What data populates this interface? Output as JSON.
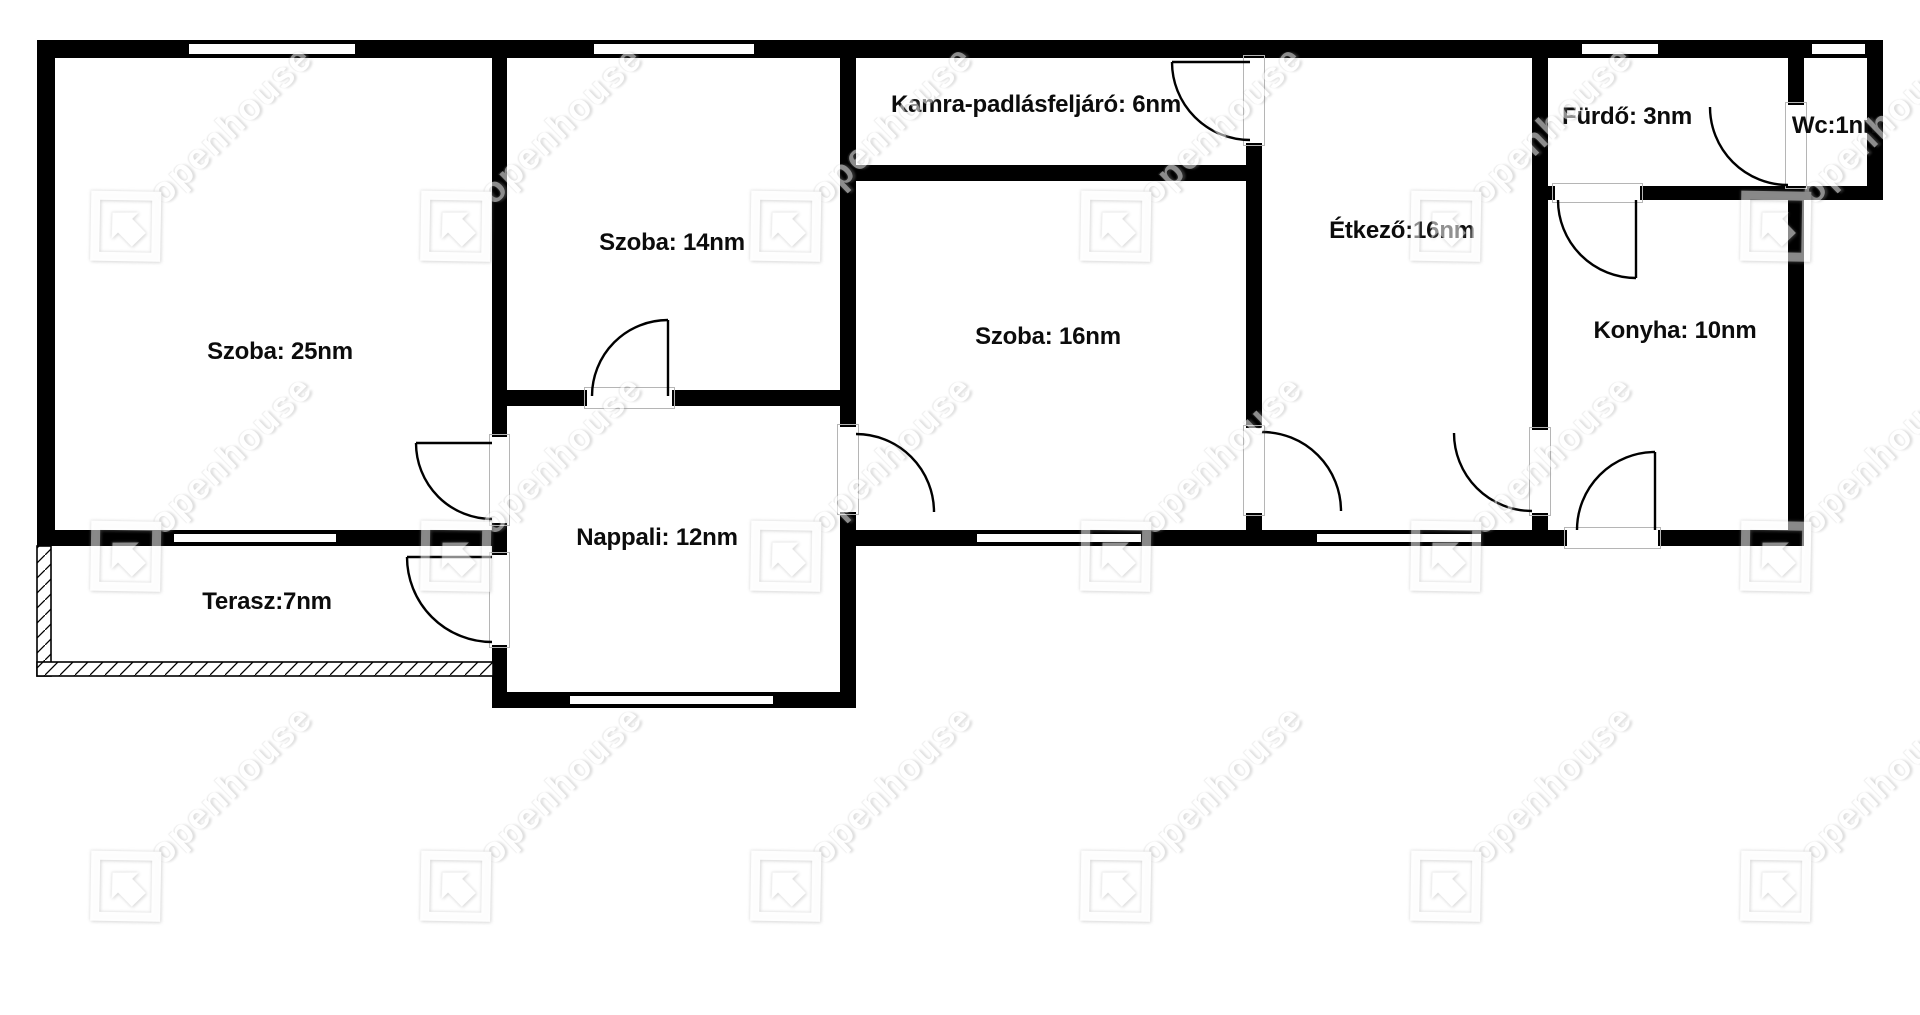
{
  "canvas": {
    "width": 1920,
    "height": 1015,
    "background": "#ffffff",
    "wall_color": "#000000"
  },
  "watermark": {
    "text": "openhouse",
    "angle_deg": -44,
    "grid": {
      "x0": 113,
      "y0": 226,
      "dx": 330,
      "dy": 330,
      "cols": 6,
      "rows": 3
    }
  },
  "rooms": [
    {
      "id": "szoba25",
      "label": "Szoba: 25nm",
      "cx": 280,
      "cy": 352
    },
    {
      "id": "szoba14",
      "label": "Szoba: 14nm",
      "cx": 672,
      "cy": 243
    },
    {
      "id": "kamra",
      "label": "Kamra-padlásfeljáró: 6nm",
      "cx": 1036,
      "cy": 105
    },
    {
      "id": "szoba16",
      "label": "Szoba: 16nm",
      "cx": 1048,
      "cy": 337
    },
    {
      "id": "etkezo",
      "label": "Étkező:16nm",
      "cx": 1402,
      "cy": 231
    },
    {
      "id": "furdo",
      "label": "Fürdő: 3nm",
      "cx": 1627,
      "cy": 117
    },
    {
      "id": "wc",
      "label": "Wc:1nm",
      "cx": 1838,
      "cy": 126
    },
    {
      "id": "konyha",
      "label": "Konyha: 10nm",
      "cx": 1675,
      "cy": 331
    },
    {
      "id": "nappali",
      "label": "Nappali: 12nm",
      "cx": 657,
      "cy": 538
    },
    {
      "id": "terasz",
      "label": "Terasz:7nm",
      "cx": 267,
      "cy": 602
    }
  ],
  "floorplan": {
    "walls": [
      [
        37,
        40,
        1846,
        18
      ],
      [
        37,
        40,
        18,
        506
      ],
      [
        37,
        530,
        470,
        16
      ],
      [
        840,
        530,
        964,
        16
      ],
      [
        492,
        58,
        15,
        650
      ],
      [
        840,
        58,
        16,
        650
      ],
      [
        492,
        692,
        364,
        16
      ],
      [
        507,
        390,
        333,
        16
      ],
      [
        856,
        165,
        390,
        16
      ],
      [
        1246,
        58,
        16,
        472
      ],
      [
        1532,
        58,
        16,
        472
      ],
      [
        1548,
        186,
        335,
        14
      ],
      [
        1788,
        58,
        16,
        488
      ],
      [
        1867,
        40,
        16,
        160
      ]
    ],
    "openings": [
      [
        492,
        437,
        15,
        86
      ],
      [
        492,
        555,
        15,
        90
      ],
      [
        587,
        390,
        85,
        16
      ],
      [
        840,
        427,
        16,
        85
      ],
      [
        1246,
        428,
        16,
        85
      ],
      [
        1246,
        58,
        16,
        85
      ],
      [
        1532,
        430,
        16,
        83
      ],
      [
        1555,
        186,
        85,
        14
      ],
      [
        1788,
        105,
        16,
        81
      ],
      [
        1567,
        530,
        91,
        16
      ]
    ],
    "windows": [
      [
        187,
        42,
        170,
        14
      ],
      [
        592,
        42,
        164,
        14
      ],
      [
        1580,
        42,
        80,
        14
      ],
      [
        1810,
        42,
        57,
        14
      ],
      [
        172,
        532,
        166,
        12
      ],
      [
        975,
        532,
        168,
        12
      ],
      [
        1315,
        532,
        168,
        12
      ],
      [
        568,
        694,
        207,
        12
      ]
    ],
    "hatched_walls": [
      [
        37,
        546,
        14,
        130
      ],
      [
        37,
        662,
        456,
        14
      ]
    ],
    "doors": [
      {
        "cx": 492,
        "cy": 443,
        "r": 76,
        "a1": 180,
        "a2": 90,
        "sweep": 0,
        "leaf": 180
      },
      {
        "cx": 492,
        "cy": 557,
        "r": 85,
        "a1": 180,
        "a2": 90,
        "sweep": 0,
        "leaf": 180
      },
      {
        "cx": 668,
        "cy": 396,
        "r": 76,
        "a1": 270,
        "a2": 180,
        "sweep": 0,
        "leaf": 270
      },
      {
        "cx": 856,
        "cy": 512,
        "r": 78,
        "a1": 270,
        "a2": 0,
        "sweep": 1,
        "leaf": null
      },
      {
        "cx": 1262,
        "cy": 511,
        "r": 79,
        "a1": 270,
        "a2": 0,
        "sweep": 1,
        "leaf": null
      },
      {
        "cx": 1250,
        "cy": 62,
        "r": 78,
        "a1": 180,
        "a2": 90,
        "sweep": 0,
        "leaf": 180
      },
      {
        "cx": 1532,
        "cy": 433,
        "r": 78,
        "a1": 180,
        "a2": 90,
        "sweep": 0,
        "leaf": null
      },
      {
        "cx": 1636,
        "cy": 200,
        "r": 78,
        "a1": 180,
        "a2": 90,
        "sweep": 0,
        "leaf": 90
      },
      {
        "cx": 1788,
        "cy": 107,
        "r": 78,
        "a1": 180,
        "a2": 90,
        "sweep": 0,
        "leaf": null
      },
      {
        "cx": 1655,
        "cy": 530,
        "r": 78,
        "a1": 180,
        "a2": 270,
        "sweep": 1,
        "leaf": 270
      }
    ]
  }
}
